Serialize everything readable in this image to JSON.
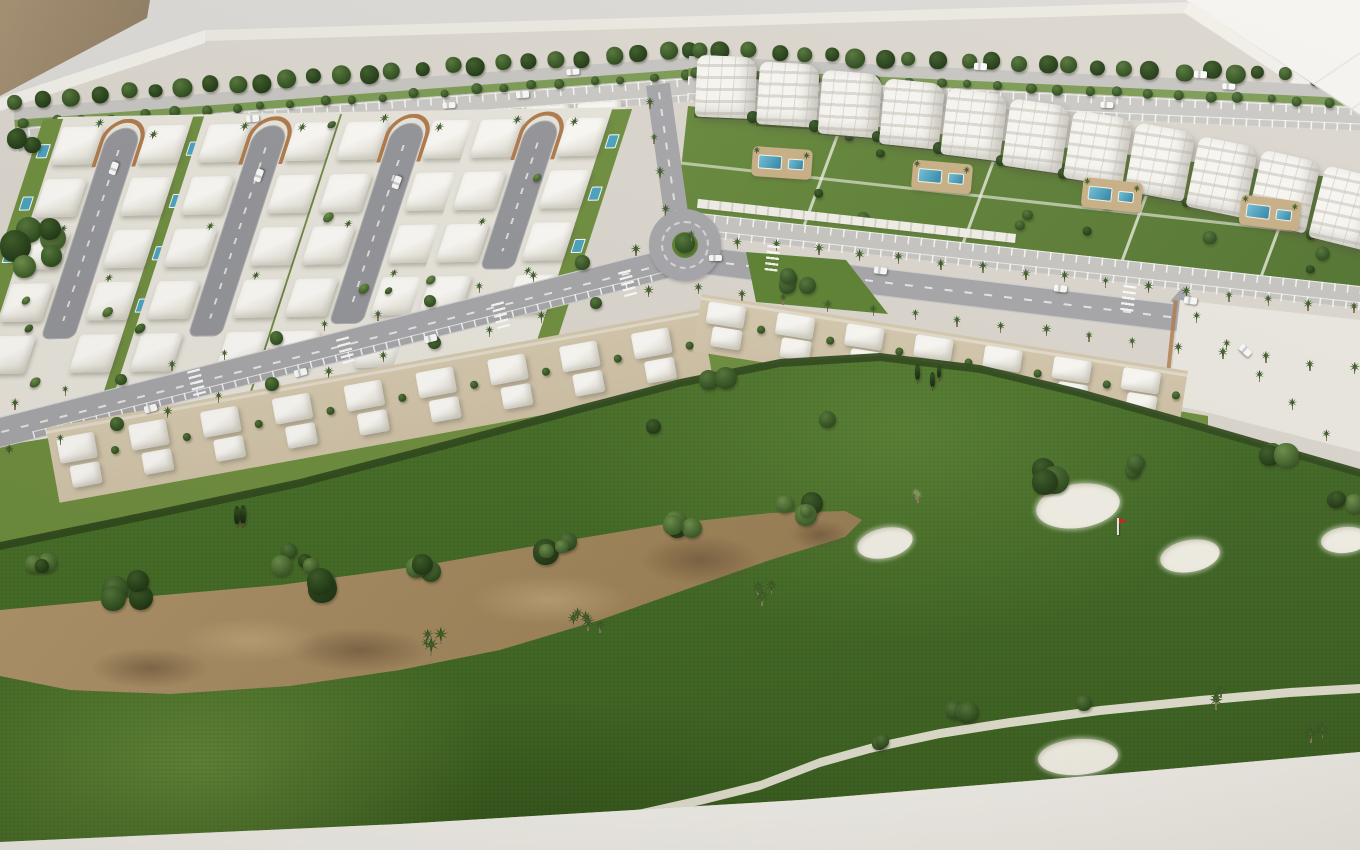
{
  "image": {
    "alt": "Aerial photograph of a white architectural scale model of a golf resort masterplan: rows of white villas with private pools along looping cul-de-sac streets, white apartment blocks with communal pools and gardens, palm-lined avenues with parking, a roundabout, terraced townhouses, and a golf course with a sandy waste area, white bunkers, a red flag pin and a cart path. The model sits on a white base in front of a tan wall."
  },
  "palette": {
    "bg": "#dcdbd8",
    "bg-bright": "#f5f4f1",
    "wall-tan": "#a59072",
    "wall-tan-dark": "#8d7a60",
    "platform": "#dcd8d0",
    "rim": "#f2f0ea",
    "road": "#a7a7ab",
    "road-light": "#c7c6c2",
    "road-dash": "#f2f2f0",
    "parking": "#cbcac6",
    "plot": "#e9e6dd",
    "sand-plot": "#d8ccb2",
    "building": "#f6f4ee",
    "building-shade": "#d8d5cb",
    "lawn": "#66893b",
    "lawn-dark": "#527430",
    "garden": "#6f8f3f",
    "hedge": "#2f4a1c",
    "golf": "#4d7a2b",
    "golf-light": "#639036",
    "golf-dark": "#3c6120",
    "waste": "#a98e64",
    "waste-dark": "#8a6f4b",
    "waste-wet": "#5a432d",
    "bunker": "#f4f2e8",
    "pool": "#49a3c0",
    "pool-deep": "#2f84a6",
    "deck": "#c9b086",
    "tree-light": "#54722f",
    "tree-dark": "#24401a",
    "palm": "#2c4a1d",
    "brick": "#b07a4a",
    "car": "#fbfbf9",
    "flag": "#cc2222",
    "path": "#e9e5d6",
    "carport": "#f2f0e9"
  },
  "scene": {
    "districts": [
      {
        "id": "villa-district",
        "label": "detached villas with private pools",
        "cul_de_sacs": 4,
        "villas_approx": 51
      },
      {
        "id": "apartment-district",
        "label": "apartment blocks with communal pools",
        "blocks": 11,
        "pool_areas": 4
      },
      {
        "id": "townhouse-rows",
        "label": "terraced townhouses facing the golf course",
        "clusters": 16
      }
    ],
    "roads": {
      "roundabouts": 1,
      "avenues": 3,
      "cul_de_sac_loops": 4
    },
    "golf": {
      "bunker_count": 5,
      "flag_count": 1,
      "waste_areas": 1,
      "cart_paths": 1
    },
    "loops": [
      {
        "x": 139,
        "len": 210
      },
      {
        "x": 286,
        "len": 210
      },
      {
        "x": 424,
        "len": 200
      },
      {
        "x": 558,
        "len": 148
      }
    ],
    "pool_decks": [
      {
        "x": 752,
        "y": 148,
        "rot": 4
      },
      {
        "x": 912,
        "y": 162,
        "rot": 5
      },
      {
        "x": 1082,
        "y": 180,
        "rot": 6
      },
      {
        "x": 1240,
        "y": 198,
        "rot": 7
      }
    ],
    "cars": [
      {
        "x": 300,
        "y": 372,
        "a": -15
      },
      {
        "x": 430,
        "y": 338,
        "a": -15
      },
      {
        "x": 150,
        "y": 408,
        "a": -15
      },
      {
        "x": 880,
        "y": 270,
        "a": 7
      },
      {
        "x": 1060,
        "y": 288,
        "a": 7
      },
      {
        "x": 1190,
        "y": 300,
        "a": 8
      },
      {
        "x": 715,
        "y": 258,
        "a": 0
      },
      {
        "x": 252,
        "y": 118,
        "a": -4
      },
      {
        "x": 522,
        "y": 94,
        "a": -4
      },
      {
        "x": 980,
        "y": 66,
        "a": 3
      },
      {
        "x": 1200,
        "y": 74,
        "a": 3
      },
      {
        "x": 113,
        "y": 168,
        "a": -70
      },
      {
        "x": 258,
        "y": 175,
        "a": -70
      },
      {
        "x": 396,
        "y": 182,
        "a": -70
      },
      {
        "x": 1245,
        "y": 350,
        "a": 43
      }
    ],
    "crosswalks": [
      {
        "x": 196,
        "y": 382,
        "a": -15
      },
      {
        "x": 345,
        "y": 350,
        "a": -15
      },
      {
        "x": 500,
        "y": 315,
        "a": -15
      },
      {
        "x": 627,
        "y": 283,
        "a": -15
      },
      {
        "x": 772,
        "y": 258,
        "a": 7
      },
      {
        "x": 1128,
        "y": 298,
        "a": 8
      }
    ],
    "palm_rows": [
      {
        "x1": 16,
        "y1": 404,
        "x2": 634,
        "y2": 248,
        "n": 13,
        "type": "mix"
      },
      {
        "x1": 8,
        "y1": 450,
        "x2": 648,
        "y2": 290,
        "n": 13,
        "type": "mix"
      },
      {
        "x1": 698,
        "y1": 288,
        "x2": 1352,
        "y2": 368,
        "n": 16,
        "type": "palm"
      },
      {
        "x1": 694,
        "y1": 236,
        "x2": 1352,
        "y2": 308,
        "n": 17,
        "type": "palm"
      },
      {
        "x1": 1196,
        "y1": 316,
        "x2": 1324,
        "y2": 432,
        "n": 5,
        "type": "palm"
      },
      {
        "x1": 648,
        "y1": 100,
        "x2": 668,
        "y2": 210,
        "n": 4,
        "type": "palm"
      }
    ],
    "bunkers": [
      {
        "x": 885,
        "y": 543,
        "rx": 28,
        "ry": 15,
        "rot": -12
      },
      {
        "x": 1078,
        "y": 506,
        "rx": 42,
        "ry": 22,
        "rot": -8
      },
      {
        "x": 1190,
        "y": 556,
        "rx": 30,
        "ry": 16,
        "rot": -10
      },
      {
        "x": 1345,
        "y": 540,
        "rx": 24,
        "ry": 13,
        "rot": -6
      },
      {
        "x": 1078,
        "y": 757,
        "rx": 40,
        "ry": 18,
        "rot": -4
      }
    ],
    "flag": {
      "x": 1117,
      "y": 535
    },
    "vegetation_clusters": [
      {
        "x": 300,
        "y": 556,
        "n": 4,
        "spread": 40,
        "rmin": 7,
        "rmax": 14,
        "type": "bush"
      },
      {
        "x": 430,
        "y": 566,
        "n": 3,
        "spread": 34,
        "rmin": 6,
        "rmax": 12,
        "type": "bush"
      },
      {
        "x": 560,
        "y": 543,
        "n": 4,
        "spread": 40,
        "rmin": 6,
        "rmax": 13,
        "type": "bush"
      },
      {
        "x": 690,
        "y": 522,
        "n": 4,
        "spread": 40,
        "rmin": 7,
        "rmax": 14,
        "type": "bush"
      },
      {
        "x": 800,
        "y": 512,
        "n": 4,
        "spread": 36,
        "rmin": 6,
        "rmax": 12,
        "type": "bush"
      },
      {
        "x": 330,
        "y": 585,
        "n": 3,
        "spread": 30,
        "rmin": 10,
        "rmax": 16,
        "type": "bush"
      },
      {
        "x": 120,
        "y": 588,
        "n": 4,
        "spread": 46,
        "rmin": 8,
        "rmax": 14,
        "type": "bush"
      },
      {
        "x": 40,
        "y": 560,
        "n": 3,
        "spread": 30,
        "rmin": 7,
        "rmax": 11,
        "type": "bush"
      },
      {
        "x": 430,
        "y": 640,
        "n": 4,
        "spread": 26,
        "rmin": 5,
        "rmax": 8,
        "type": "palm-tall"
      },
      {
        "x": 590,
        "y": 620,
        "n": 5,
        "spread": 34,
        "rmin": 5,
        "rmax": 8,
        "type": "palm-tall"
      },
      {
        "x": 770,
        "y": 590,
        "n": 3,
        "spread": 26,
        "rmin": 5,
        "rmax": 7,
        "type": "palm-tall"
      },
      {
        "x": 240,
        "y": 516,
        "n": 2,
        "spread": 14,
        "rmin": 6,
        "rmax": 8,
        "type": "conifer"
      },
      {
        "x": 722,
        "y": 384,
        "n": 2,
        "spread": 26,
        "rmin": 8,
        "rmax": 11,
        "type": "round"
      },
      {
        "x": 928,
        "y": 377,
        "n": 3,
        "spread": 26,
        "rmin": 4,
        "rmax": 6,
        "type": "conifer"
      },
      {
        "x": 830,
        "y": 420,
        "n": 1,
        "spread": 8,
        "rmin": 8,
        "rmax": 10,
        "type": "round"
      },
      {
        "x": 655,
        "y": 428,
        "n": 1,
        "spread": 6,
        "rmin": 7,
        "rmax": 9,
        "type": "bush"
      },
      {
        "x": 800,
        "y": 278,
        "n": 4,
        "spread": 34,
        "rmin": 6,
        "rmax": 10,
        "type": "round"
      },
      {
        "x": 1050,
        "y": 475,
        "n": 3,
        "spread": 30,
        "rmin": 9,
        "rmax": 15,
        "type": "bush"
      },
      {
        "x": 1135,
        "y": 468,
        "n": 2,
        "spread": 20,
        "rmin": 7,
        "rmax": 11,
        "type": "bush"
      },
      {
        "x": 1282,
        "y": 452,
        "n": 3,
        "spread": 26,
        "rmin": 8,
        "rmax": 13,
        "type": "bush"
      },
      {
        "x": 1345,
        "y": 505,
        "n": 3,
        "spread": 24,
        "rmin": 8,
        "rmax": 12,
        "type": "bush"
      },
      {
        "x": 912,
        "y": 492,
        "n": 2,
        "spread": 16,
        "rmin": 5,
        "rmax": 6,
        "type": "palm-pale"
      },
      {
        "x": 965,
        "y": 712,
        "n": 3,
        "spread": 26,
        "rmin": 7,
        "rmax": 11,
        "type": "round"
      },
      {
        "x": 1085,
        "y": 702,
        "n": 1,
        "spread": 6,
        "rmin": 8,
        "rmax": 10,
        "type": "round"
      },
      {
        "x": 1230,
        "y": 698,
        "n": 3,
        "spread": 30,
        "rmin": 5,
        "rmax": 7,
        "type": "palm-tall"
      },
      {
        "x": 1320,
        "y": 730,
        "n": 2,
        "spread": 20,
        "rmin": 5,
        "rmax": 7,
        "type": "palm-tall"
      },
      {
        "x": 880,
        "y": 745,
        "n": 2,
        "spread": 18,
        "rmin": 6,
        "rmax": 9,
        "type": "round"
      },
      {
        "x": 14,
        "y": 250,
        "n": 7,
        "spread": 95,
        "rmin": 9,
        "rmax": 16,
        "type": "bush"
      },
      {
        "x": 28,
        "y": 140,
        "n": 3,
        "spread": 30,
        "rmin": 8,
        "rmax": 13,
        "type": "bush"
      }
    ]
  }
}
